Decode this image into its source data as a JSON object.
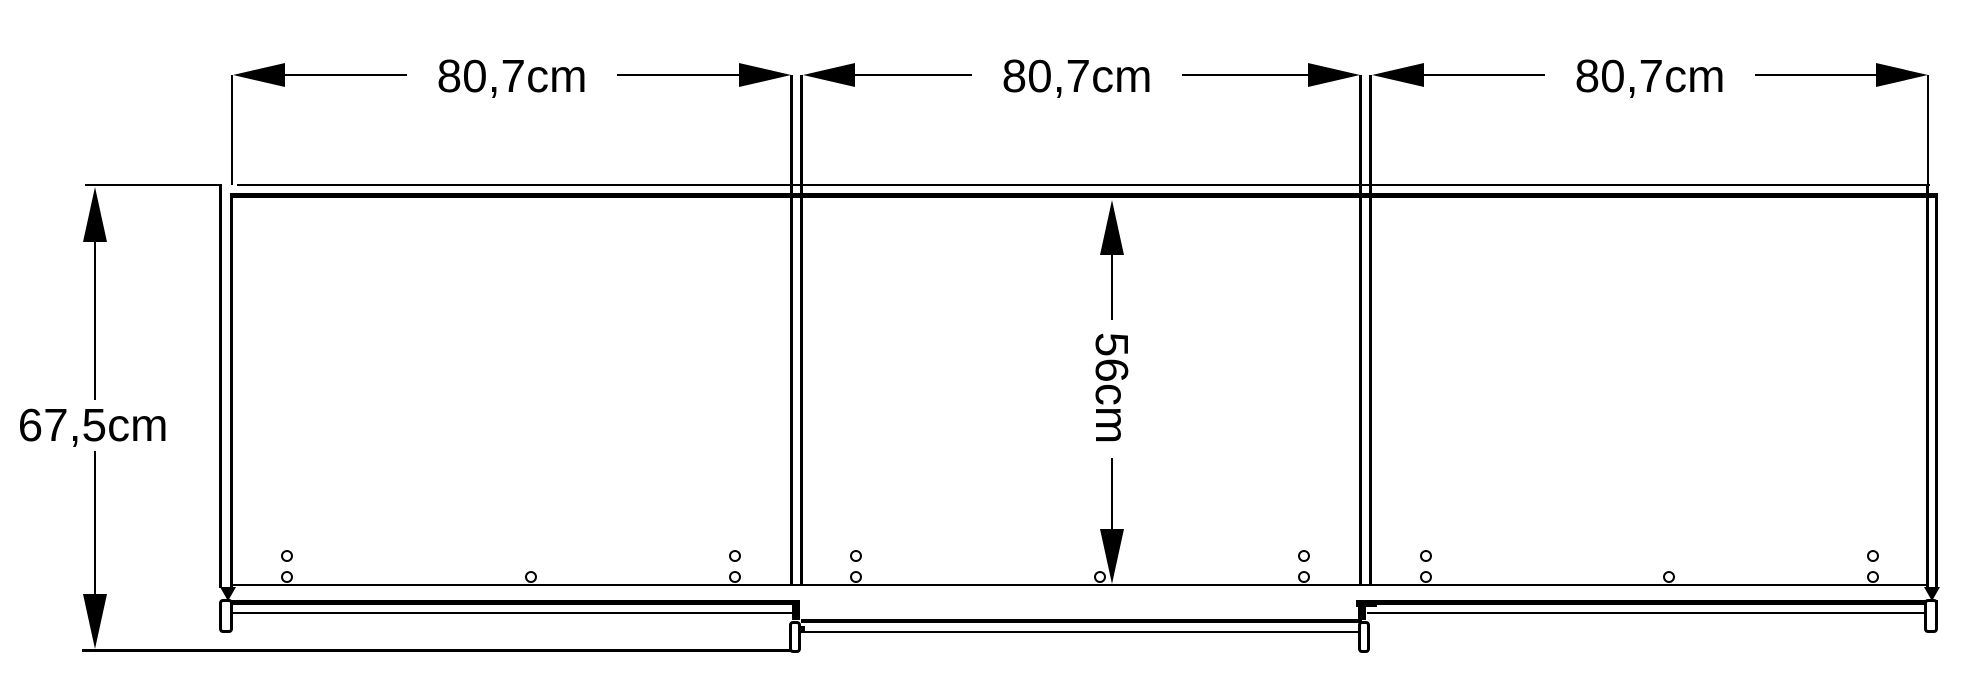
{
  "drawing": {
    "kind": "furniture-dimension-drawing",
    "unit": "cm",
    "colors": {
      "line": "#000000",
      "background": "#ffffff"
    }
  },
  "labels": {
    "width": [
      "80,7cm",
      "80,7cm",
      "80,7cm"
    ],
    "height": "67,5cm",
    "interior_height": "56cm"
  }
}
